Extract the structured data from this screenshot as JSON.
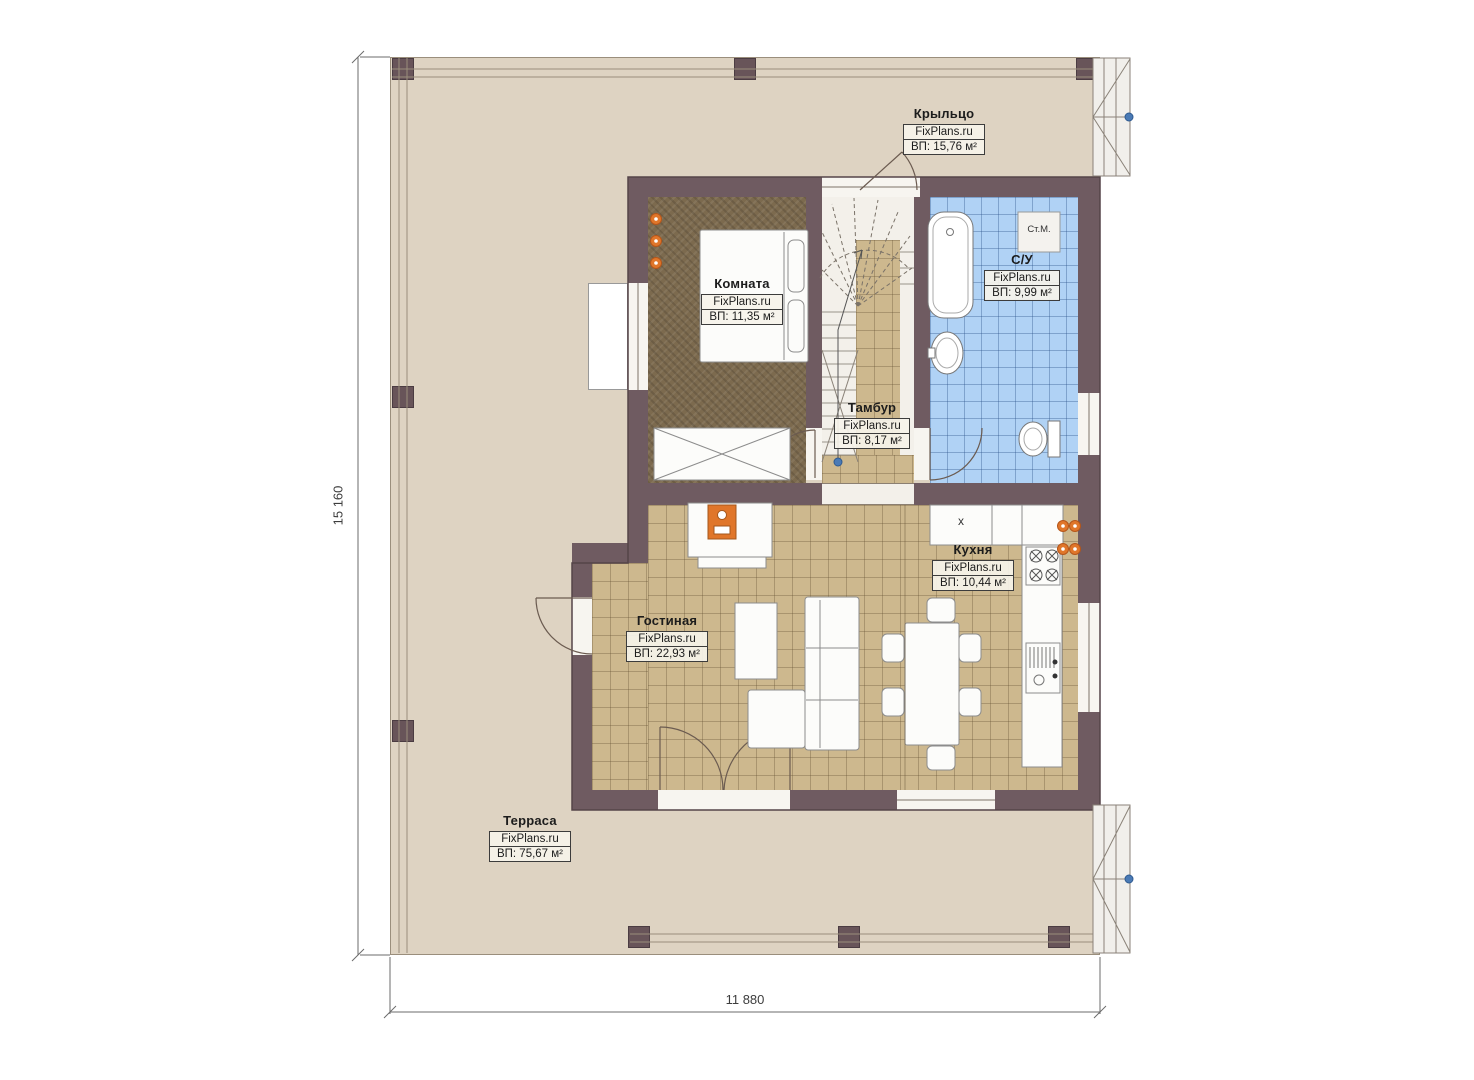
{
  "rooms": [
    {
      "key": "porch",
      "name": "Крыльцо",
      "brand": "FixPlans.ru",
      "area": "ВП: 15,76 м²"
    },
    {
      "key": "bedroom",
      "name": "Комната",
      "brand": "FixPlans.ru",
      "area": "ВП: 11,35 м²"
    },
    {
      "key": "bathroom",
      "name": "С/У",
      "brand": "FixPlans.ru",
      "area": "ВП: 9,99 м²"
    },
    {
      "key": "vestibule",
      "name": "Тамбур",
      "brand": "FixPlans.ru",
      "area": "ВП: 8,17 м²"
    },
    {
      "key": "kitchen",
      "name": "Кухня",
      "brand": "FixPlans.ru",
      "area": "ВП: 10,44 м²"
    },
    {
      "key": "living-room",
      "name": "Гостиная",
      "brand": "FixPlans.ru",
      "area": "ВП: 22,93 м²"
    },
    {
      "key": "terrace",
      "name": "Терраса",
      "brand": "FixPlans.ru",
      "area": "ВП: 75,67 м²"
    }
  ],
  "dimensions": {
    "vertical": "15 160",
    "horizontal": "11 880"
  },
  "annotations": {
    "washing_machine": "Ст.М.",
    "kitchen_cabinet": "x"
  },
  "colors": {
    "wall": "#6f5b61",
    "terrace": "#ded3c2",
    "tile_floor": "#cdb88e",
    "bath_tile": "#b0d2f5",
    "room_floor": "#7c6a4e",
    "accent_orange": "#e0762a",
    "marker_blue": "#4a7ab5"
  }
}
